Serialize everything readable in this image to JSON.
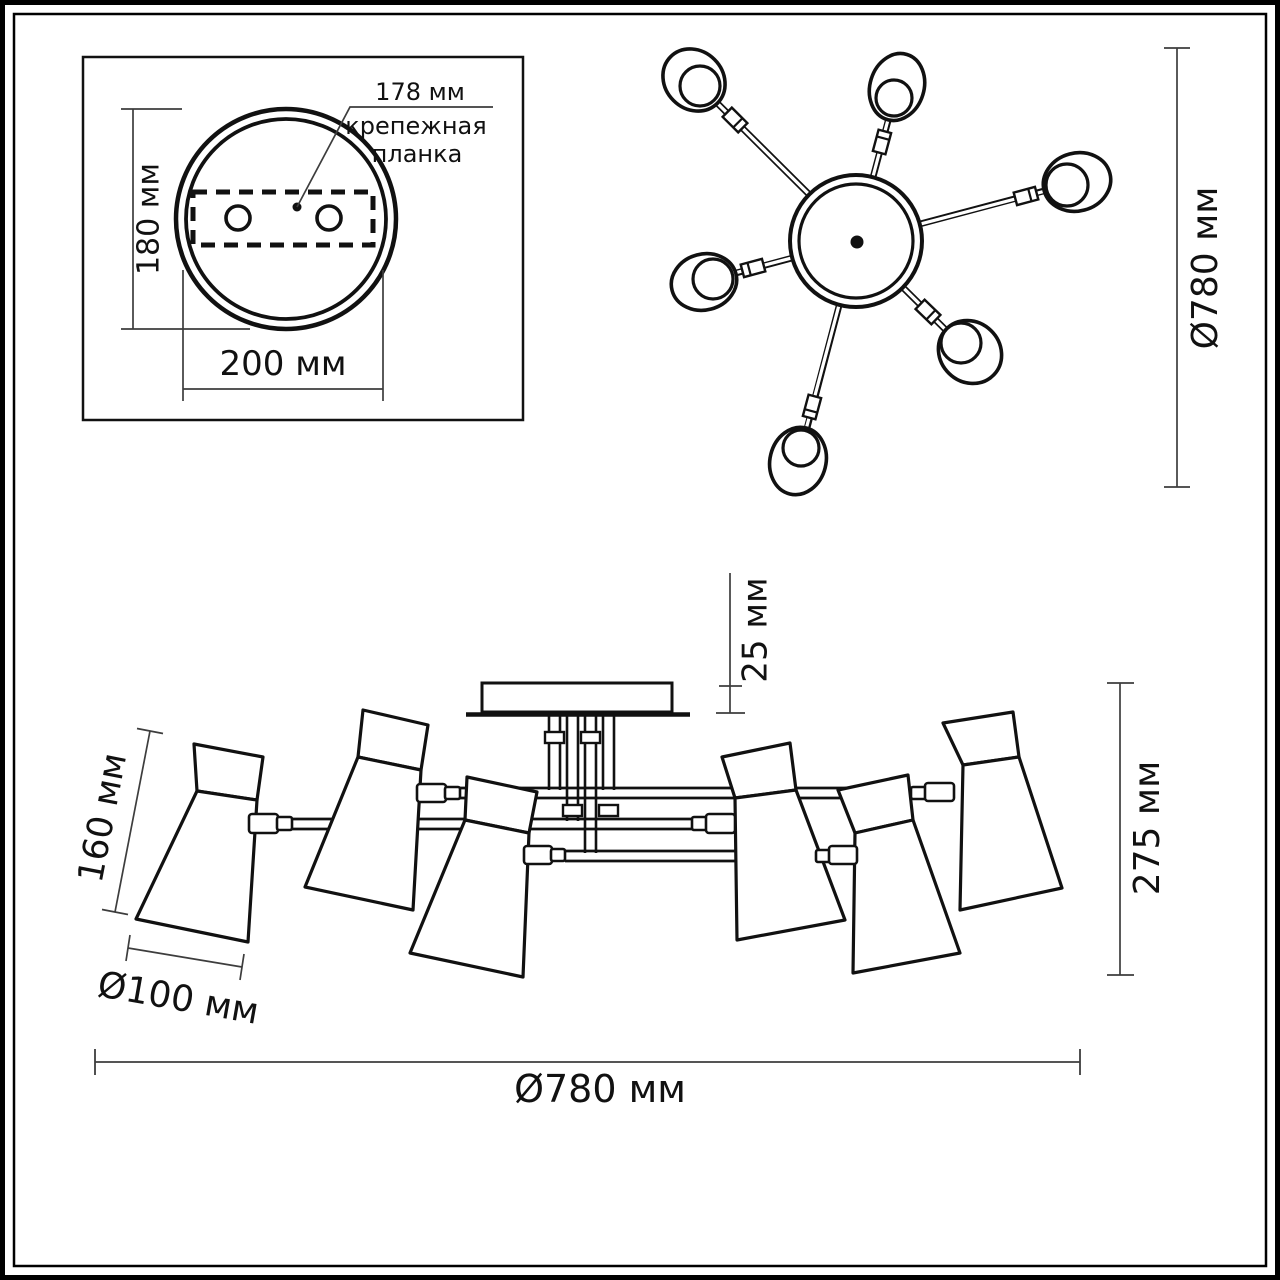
{
  "drawing": {
    "type": "technical dimension drawing of a 6-shade ceiling chandelier, three views",
    "colors": {
      "background": "#ffffff",
      "line": "#111111",
      "dim_line": "#3d3d3d",
      "text": "#111111"
    },
    "mount_detail": {
      "plate_height": "180 мм",
      "plate_width": "200 мм",
      "bar_offset": "178 мм",
      "bar_name_1": "крепежная",
      "bar_name_2": "планка"
    },
    "top_view": {
      "diameter": "Ø780 мм",
      "shade_count": 6
    },
    "side_view": {
      "canopy_height": "25 мм",
      "total_height": "275 мм",
      "shade_height": "160 мм",
      "shade_diameter": "Ø100 мм",
      "overall_diameter": "Ø780 мм"
    }
  }
}
